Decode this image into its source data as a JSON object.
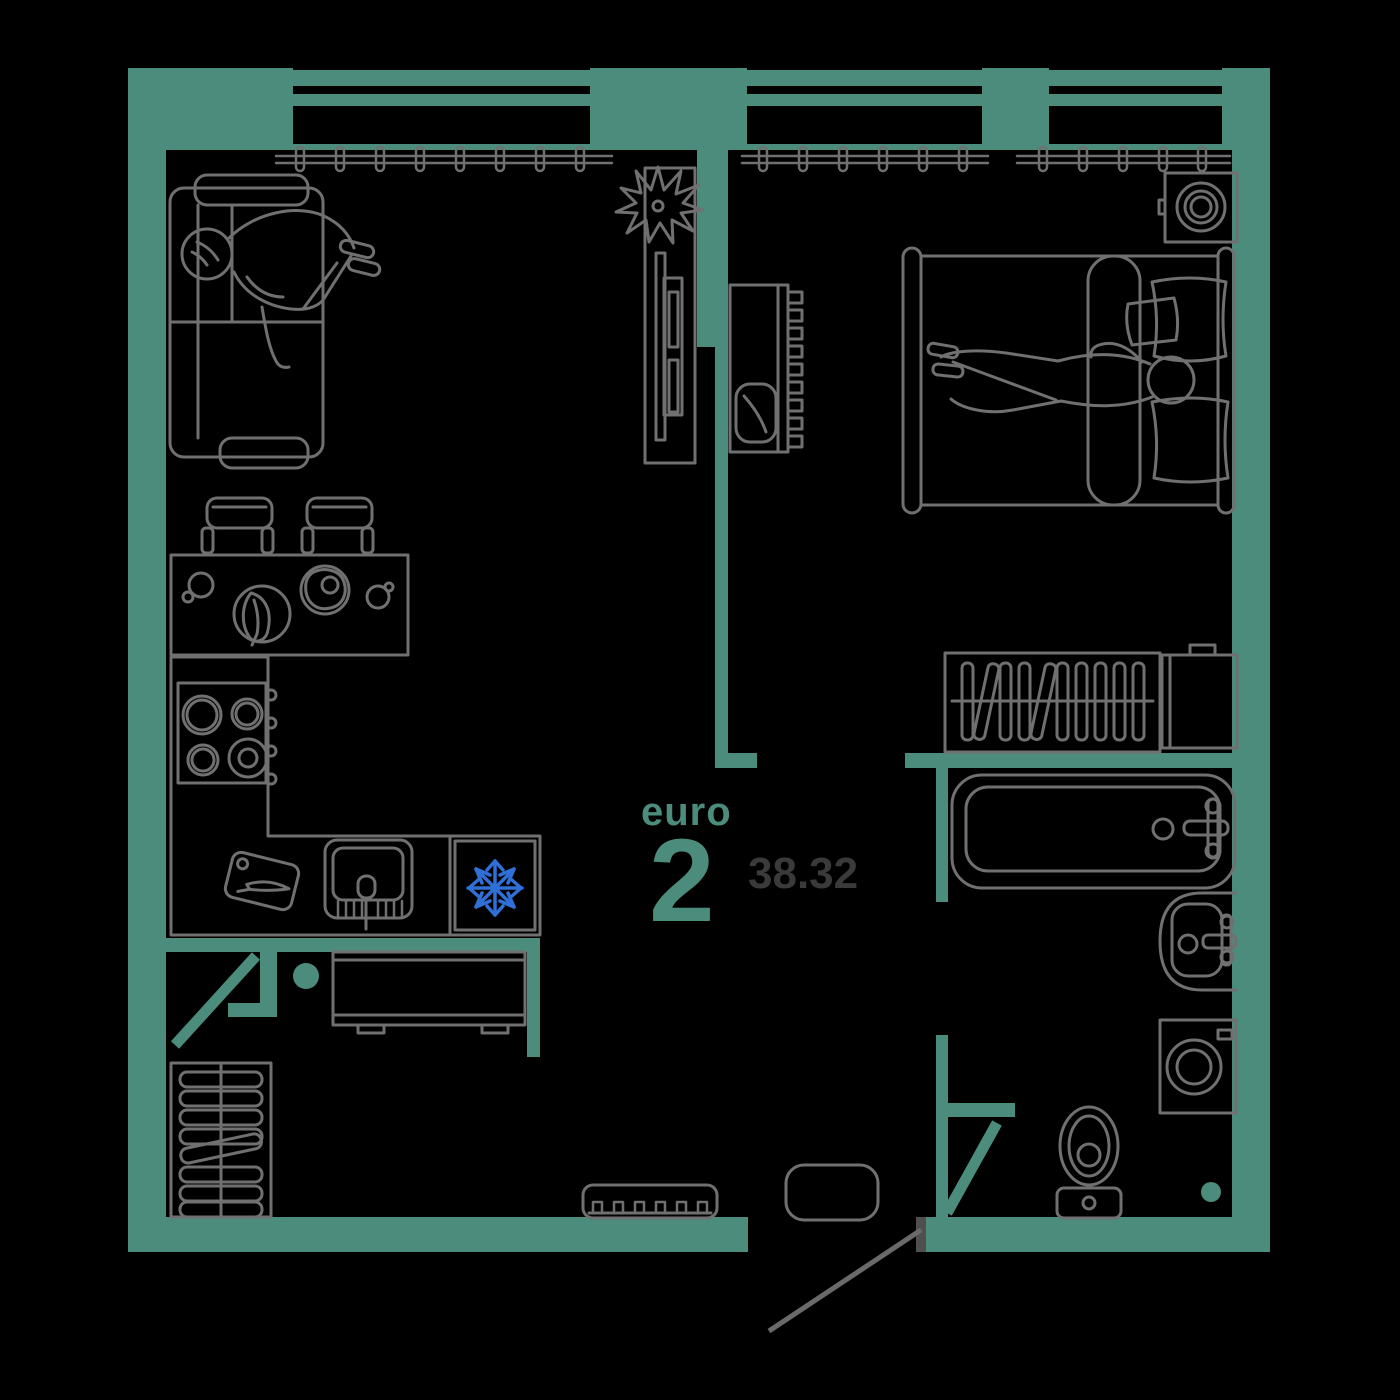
{
  "floorplan": {
    "title": {
      "type_label": "euro",
      "rooms_number": "2",
      "area_value": "38.32"
    },
    "colors": {
      "bg": "#000000",
      "wall": "#4C8C7D",
      "line": "#707070",
      "snow": "#2F6FD6",
      "jamb": "#4F4F4F",
      "areatext": "#3A3A3A"
    },
    "rooms": [
      "living-room-with-kitchen",
      "bedroom",
      "bathroom",
      "hallway",
      "storage-closet"
    ],
    "furniture_icons": [
      "sofa-icon",
      "person-on-sofa-icon",
      "plant-icon",
      "tv-stand-icon",
      "dressing-table-icon",
      "stool-icon",
      "dining-table-icon",
      "chair-icon",
      "stove-icon",
      "kitchen-sink-icon",
      "fridge-snowflake-icon",
      "cutting-board-icon",
      "bed-icon",
      "person-on-bed-icon",
      "pillow-icon",
      "round-sink-icon",
      "wardrobe-hangers-icon",
      "cabinet-icon",
      "bathtub-icon",
      "washbasin-icon",
      "washing-machine-icon",
      "toilet-icon",
      "radiator-icon",
      "console-table-icon",
      "doormat-icon",
      "pouf-icon",
      "curtain-rail-icon",
      "window-icon",
      "door-swing-icon"
    ]
  }
}
